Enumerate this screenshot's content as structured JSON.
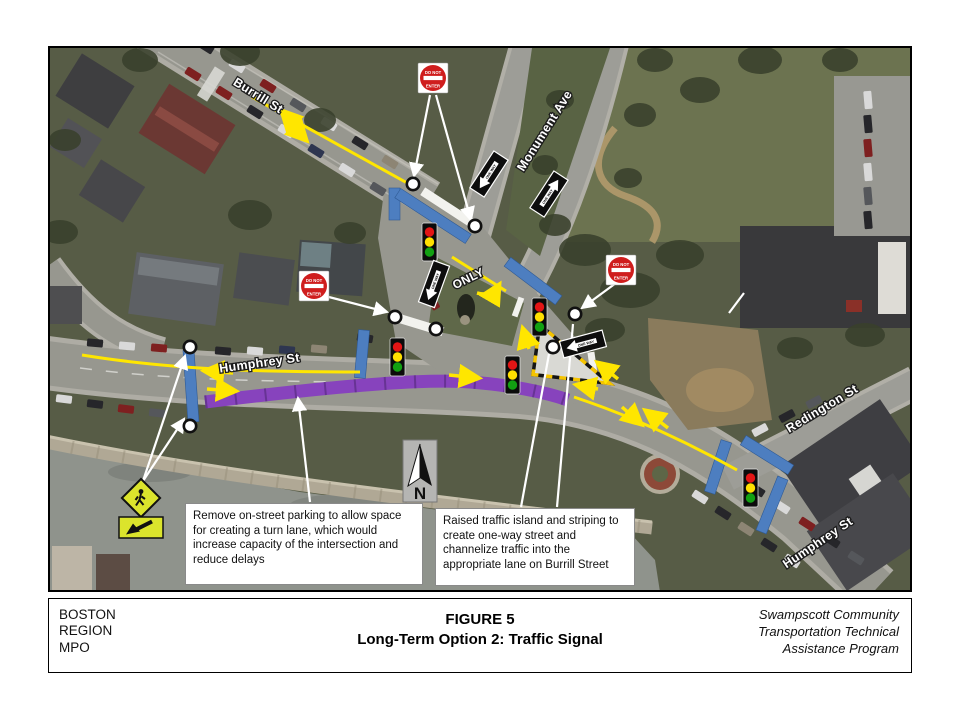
{
  "footer": {
    "org_lines": [
      "BOSTON",
      "REGION",
      "MPO"
    ],
    "figure_label": "FIGURE 5",
    "figure_title": "Long-Term Option 2: Traffic Signal",
    "program_lines": [
      "Swampscott Community",
      "Transportation Technical",
      "Assistance Program"
    ]
  },
  "map": {
    "street_labels": [
      {
        "id": "burrill",
        "text": "Burrill St"
      },
      {
        "id": "monument",
        "text": "Monument Ave"
      },
      {
        "id": "humphrey-west",
        "text": "Humphrey St"
      },
      {
        "id": "redington",
        "text": "Redington St"
      },
      {
        "id": "humphrey-east",
        "text": "Humphrey St"
      }
    ],
    "road_marking_only": "ONLY",
    "north_label": "N",
    "signs": {
      "do_not_enter_line1": "DO NOT",
      "do_not_enter_line2": "ENTER",
      "one_way": "ONE WAY"
    },
    "callouts": [
      {
        "text": "Remove on-street parking to allow space for creating a turn lane, which would increase capacity of  the intersection and reduce delays"
      },
      {
        "text": "Raised traffic island and striping to create one-way street and channelize traffic into the appropriate lane on Burrill Street"
      }
    ],
    "annotation_colors": {
      "proposed_crosswalk_blue": "#4d7ec0",
      "parking_removal_purple": "#8743bd",
      "traffic_flow_yellow": "#ffe600",
      "signal_red": "#e31515",
      "signal_yellow": "#ffe000",
      "signal_green": "#12a012",
      "do_not_enter_red": "#cf1d1d",
      "ped_sign_green": "#dbe42c"
    }
  }
}
